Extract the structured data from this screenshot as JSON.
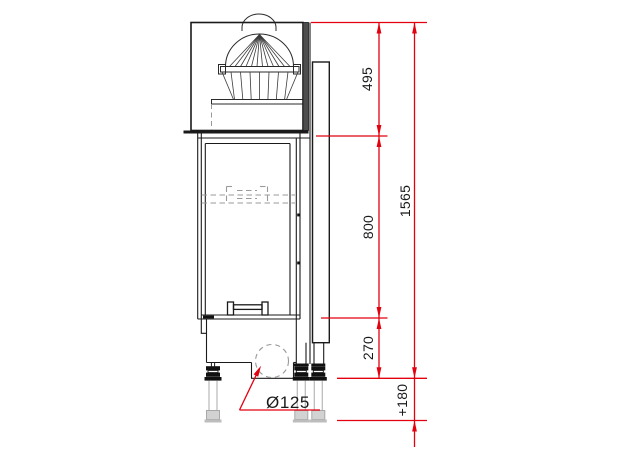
{
  "drawing": {
    "type": "technical-elevation-fireplace-insert",
    "labels": {
      "dim_top_section": "495",
      "dim_firebox_section": "800",
      "dim_base_section": "270",
      "dim_total_height": "1565",
      "dim_leg_adjustment": "+180",
      "dim_air_intake_diameter": "Ø125"
    },
    "colors": {
      "dimension_line": "#e3000f",
      "line": "#1a1a1a",
      "hidden_line": "#999999",
      "ghost_part": "#bdbdbd"
    }
  }
}
